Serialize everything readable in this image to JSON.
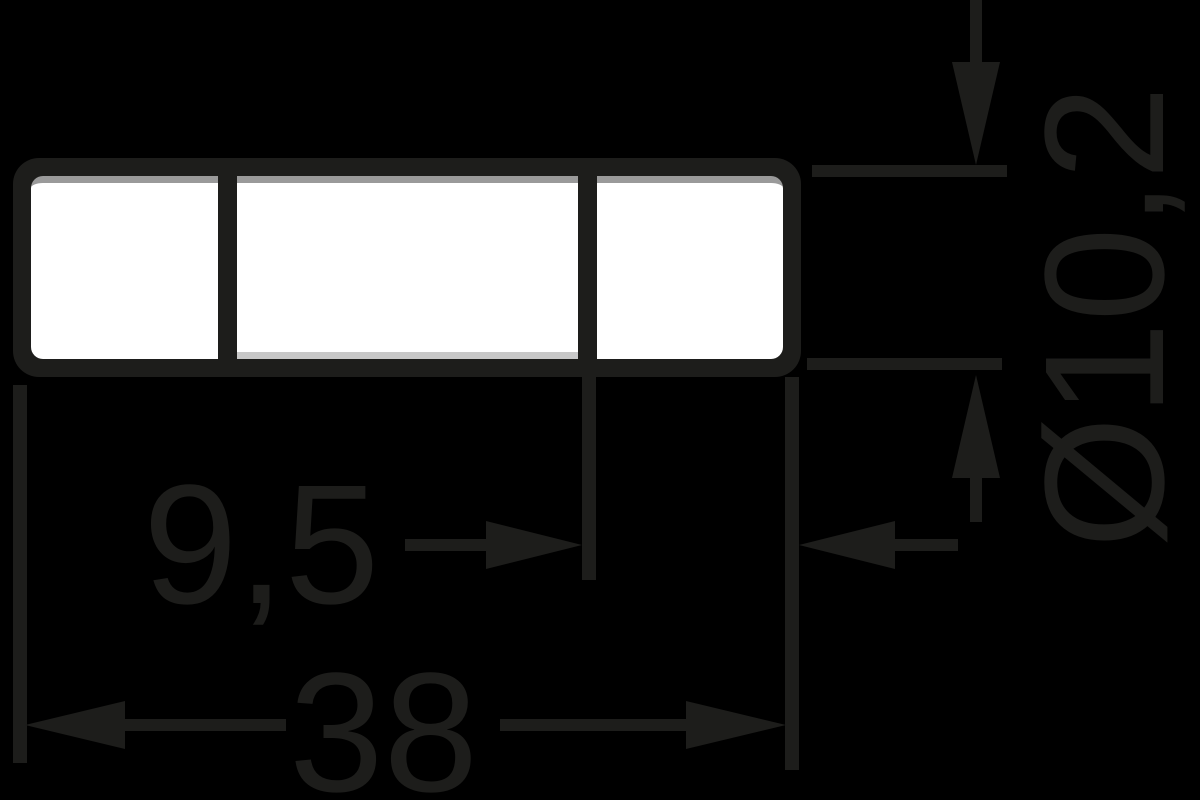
{
  "colors": {
    "background": "#000000",
    "ink": "#1d1d1b",
    "fill": "#ffffff",
    "shade_top": "#9a9a9a",
    "shade_bottom": "#c8c8c8"
  },
  "dimensions": {
    "cap_length": "9,5",
    "overall_length": "38",
    "diameter": "Ø10,2"
  }
}
